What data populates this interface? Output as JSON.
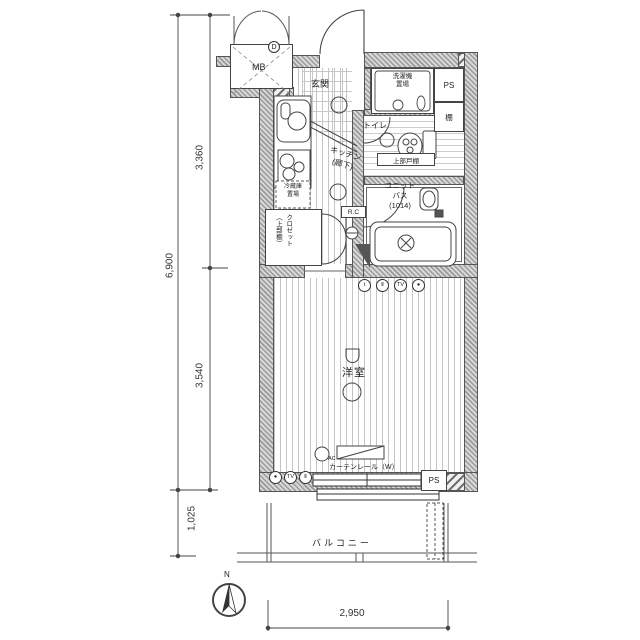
{
  "labels": {
    "mb": "MB",
    "d": "D",
    "genkan": "玄関",
    "washer_line1": "洗濯機",
    "washer_line2": "置場",
    "ps_top": "PS",
    "shelf": "棚",
    "toilet": "トイレ",
    "upper_cabinet": "上部戸棚",
    "bath_line1": "ユニット",
    "bath_line2": "バス",
    "bath_line3": "(1014)",
    "rc": "R.C",
    "kitchen_line1": "キッチン",
    "kitchen_line2": "(廊下)",
    "fridge_line1": "冷蔵庫",
    "fridge_line2": "置場",
    "closet_line1": "クロゼット",
    "closet_line2": "（上部棚）",
    "room": "洋室",
    "curtain_rail": "カーテンレール（W）",
    "ac": "AC",
    "balcony": "バルコニー",
    "ps_bottom": "PS",
    "north": "N"
  },
  "dimensions": {
    "upper": "3,360",
    "total": "6,900",
    "lower": "3,540",
    "balcony": "1,025",
    "width": "2,950"
  },
  "outlets": {
    "bath_wall": [
      "t",
      "Ⅱ",
      "TV",
      "●"
    ],
    "room_wall": [
      "●",
      "TV",
      "Ⅱ"
    ]
  }
}
